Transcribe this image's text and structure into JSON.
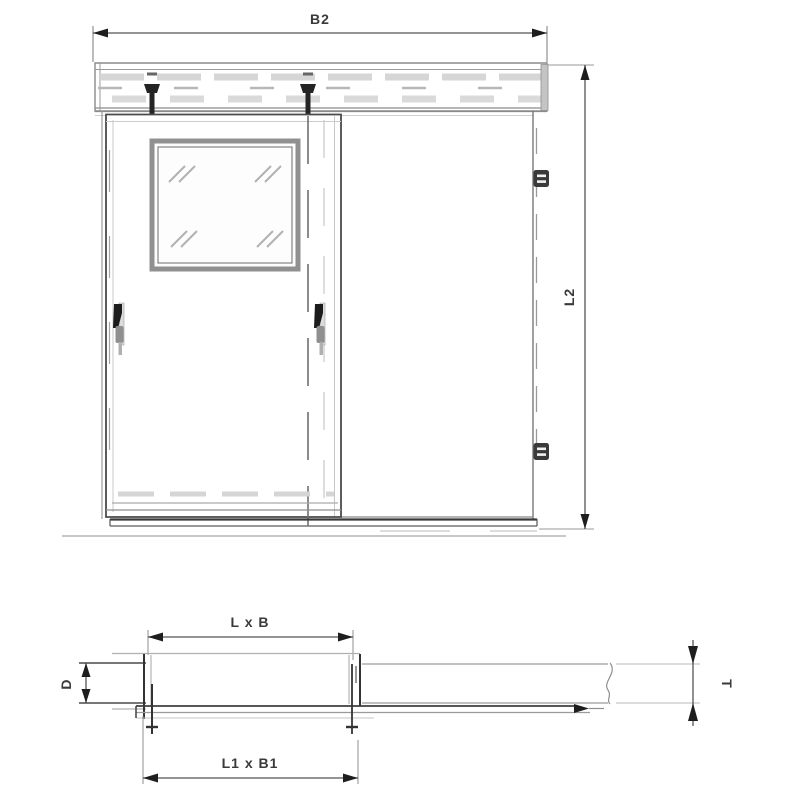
{
  "drawing": {
    "labels": {
      "b2": "B2",
      "l2": "L2",
      "l_x_b": "L x B",
      "d": "D",
      "t": "T",
      "l1_x_b1": "L1 x B1"
    },
    "colors": {
      "background": "#ffffff",
      "outline_dark": "#3c3c3c",
      "outline_medium": "#8a8a8a",
      "outline_light": "#c6c6c6",
      "arrow_fill": "#1e1e1e",
      "label_text": "#3a3a3a"
    }
  }
}
